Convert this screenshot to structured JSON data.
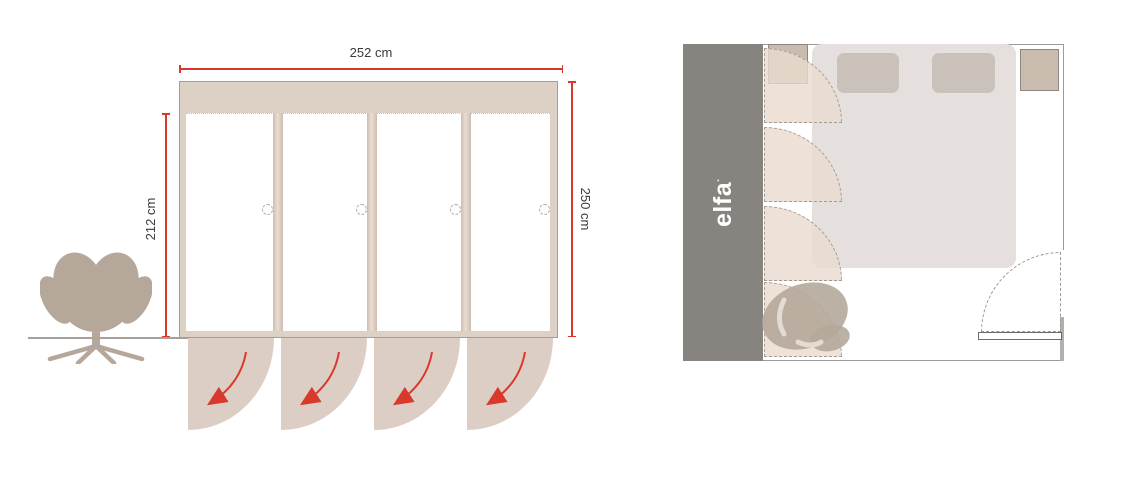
{
  "front_view": {
    "width_label": "252 cm",
    "door_height_label": "212 cm",
    "total_height_label": "250 cm"
  },
  "floor_plan": {
    "brand": "elfa",
    "brand_mark": "·"
  },
  "colors": {
    "accent_red": "#d9392c",
    "text_dark": "#3e3a37",
    "wardrobe_frame": "#ddd0c4",
    "swing_fill": "#dccec4",
    "chair_taupe": "#b5a89b",
    "floor_gray": "#a5a09b",
    "plan_wardrobe": "#87837f",
    "plan_wall": "#9b9b9b",
    "plan_arc_fill": "rgba(234,219,206,0.8)",
    "bed": "#e5dfde",
    "pillow": "#cac1ba",
    "nightstand": "#c9bcae",
    "brand_white": "#ffffff"
  }
}
